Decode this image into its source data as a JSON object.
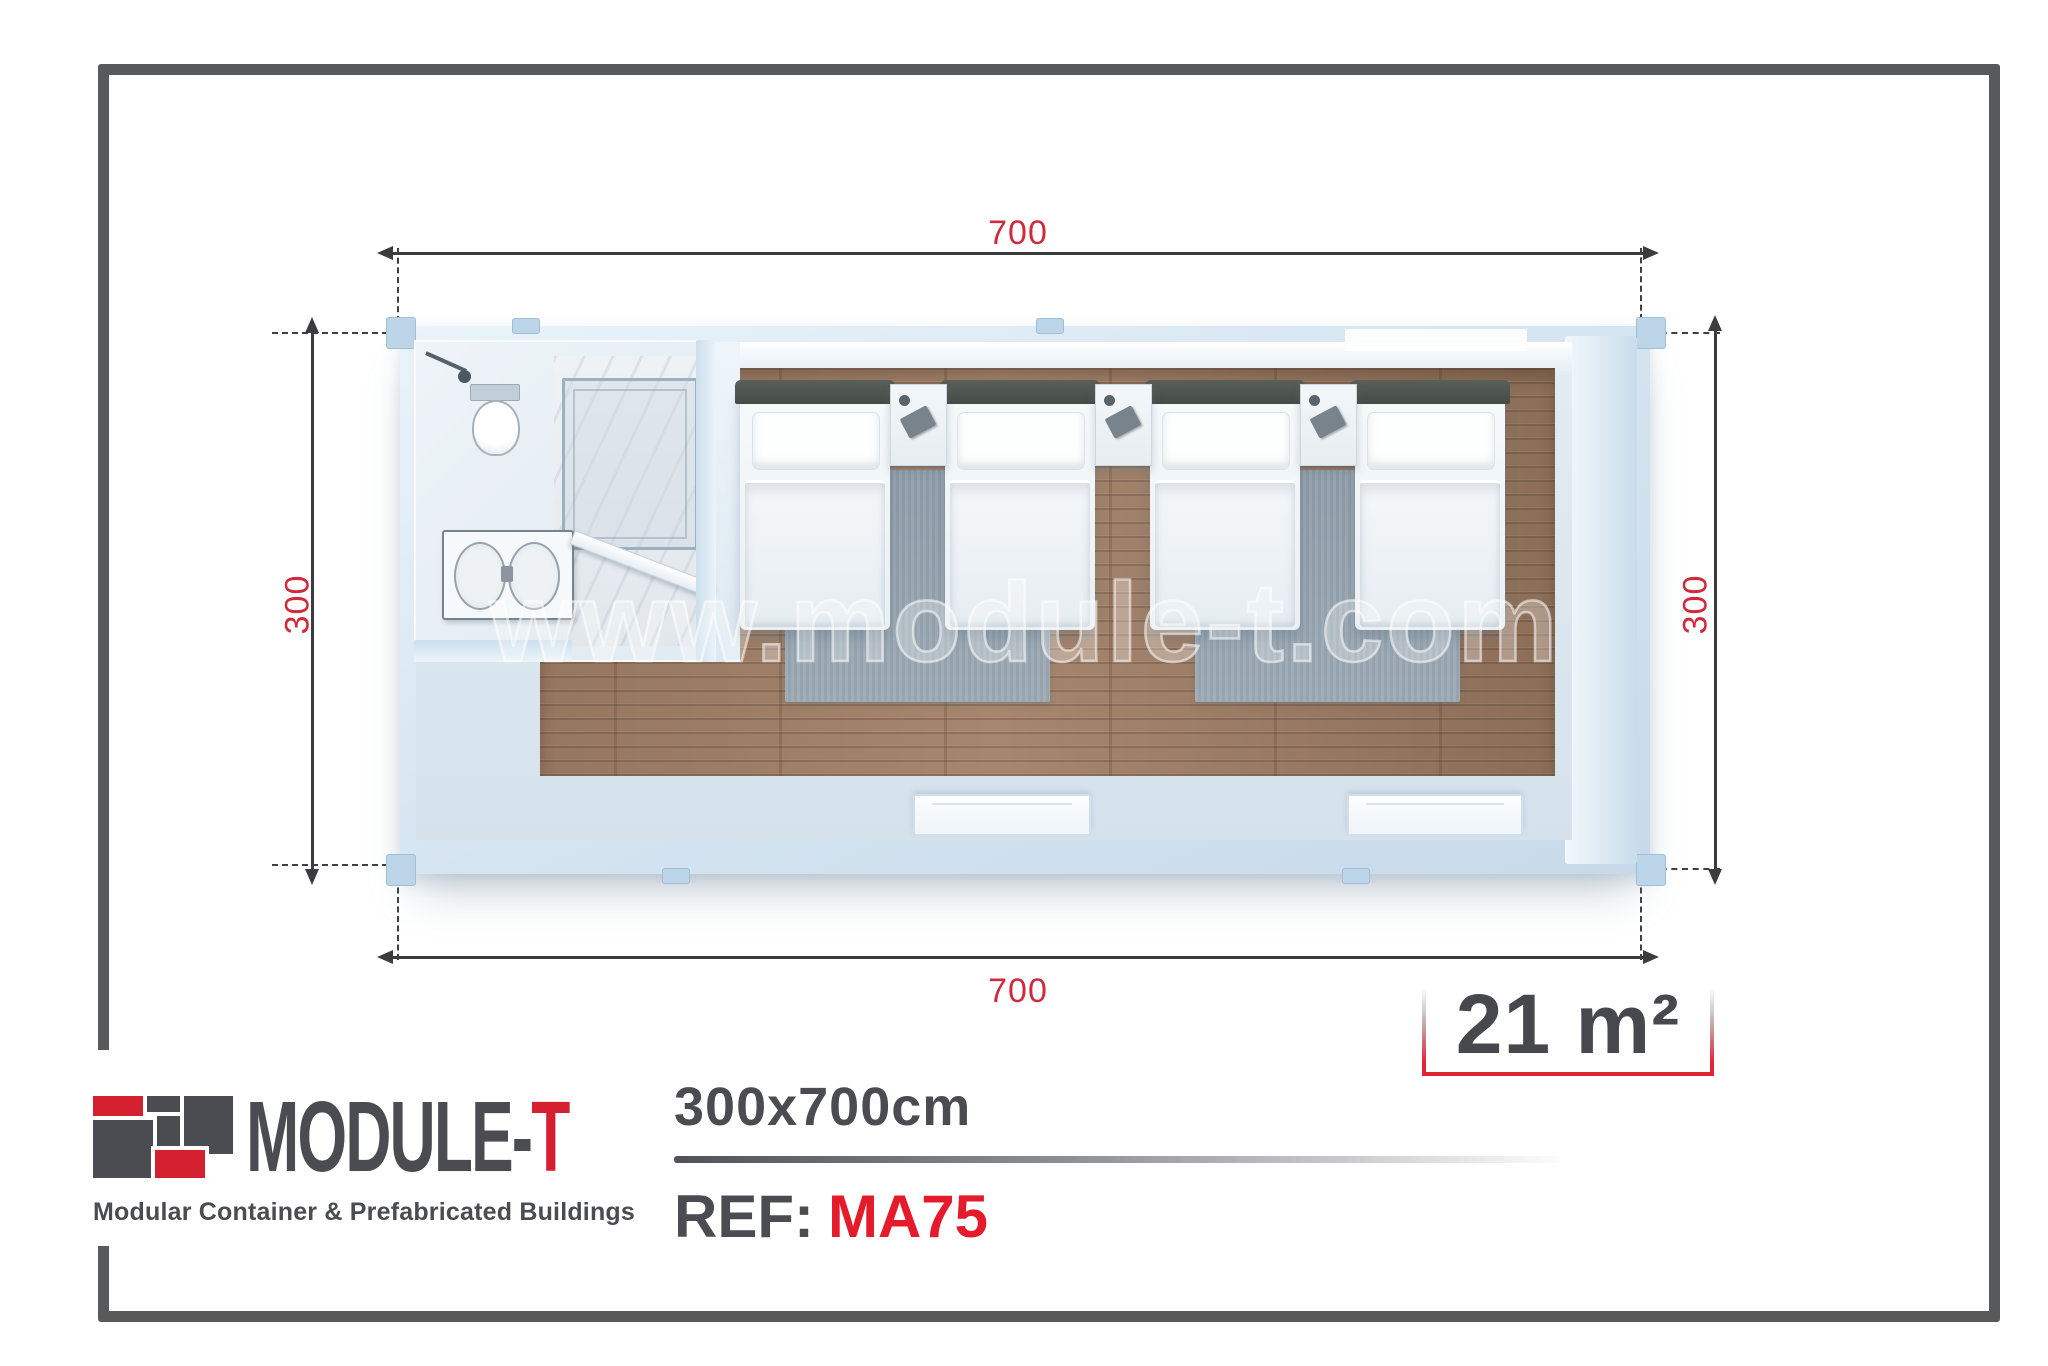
{
  "dimensions": {
    "top_cm": "700",
    "bottom_cm": "700",
    "left_cm": "300",
    "right_cm": "300"
  },
  "area": {
    "value": "21 m²"
  },
  "watermark": "www.module-t.com",
  "brand": {
    "name_main": "MODULE-",
    "name_accent": "T",
    "tagline": "Modular Container & Prefabricated Buildings"
  },
  "footer": {
    "size_label": "300x700cm",
    "ref_label": "REF:",
    "ref_value": "MA75"
  },
  "colors": {
    "accent_red": "#d4202f",
    "dimension_red": "#cf2b3c",
    "ref_red": "#e51a2b",
    "dark_gray": "#4b4c51",
    "frame_gray": "#58595b",
    "wall_blue": "#d3e3f0",
    "wood_brown": "#9b7b64",
    "rug_gray": "#90a0ac"
  },
  "plan": {
    "type": "floor-plan",
    "rooms": [
      "bathroom",
      "bedroom"
    ],
    "furniture": {
      "beds": 4,
      "nightstands": 3,
      "rugs": 2,
      "windows": 2
    },
    "bathroom_fixtures": [
      "shower",
      "toilet",
      "sink",
      "door"
    ]
  }
}
